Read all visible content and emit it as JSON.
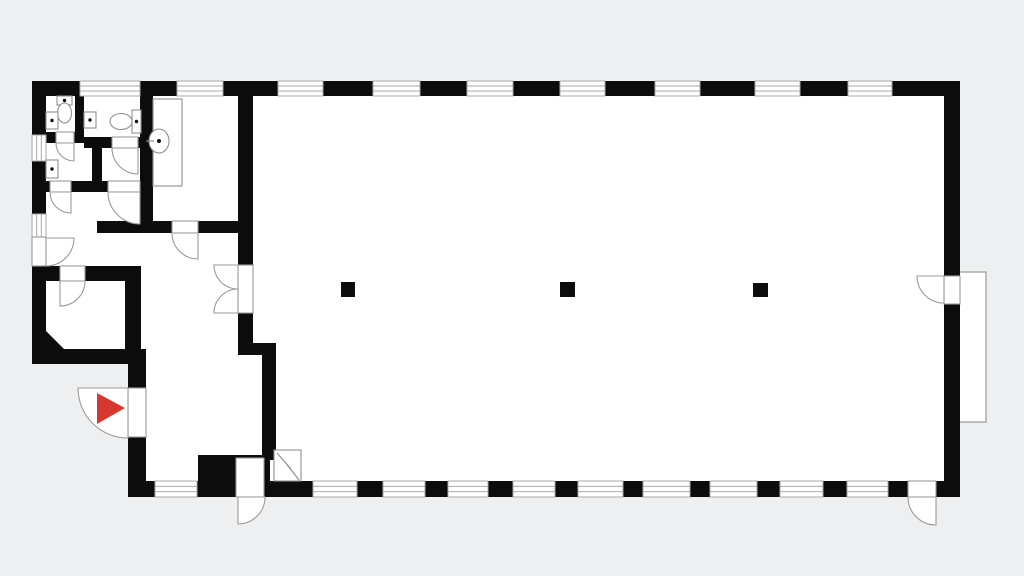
{
  "meta": {
    "title": "floor-plan-drawing"
  },
  "colors": {
    "background": "#eeeff0",
    "floor": "#ffffff",
    "wall": "#0c0c0c",
    "line": "#9a9a9a",
    "window_line": "#a9a9a9",
    "fixture_line": "#8f8f8f",
    "dot": "#111111",
    "marker_red": "#d63731"
  },
  "plan": {
    "viewbox": "0 0 1024 576",
    "floor_outline": "32,81 960,81 960,497 128,497 128,364 32,364",
    "platform": {
      "name": "exterior-platform",
      "x": 956,
      "y": 272,
      "w": 30,
      "h": 150
    },
    "walls": [
      [
        32,
        81,
        48,
        15
      ],
      [
        140,
        81,
        37,
        15
      ],
      [
        223,
        81,
        55,
        15
      ],
      [
        323,
        81,
        50,
        15
      ],
      [
        420,
        81,
        47,
        15
      ],
      [
        513,
        81,
        47,
        15
      ],
      [
        605,
        81,
        50,
        15
      ],
      [
        700,
        81,
        55,
        15
      ],
      [
        800,
        81,
        48,
        15
      ],
      [
        892,
        81,
        68,
        15
      ],
      [
        128,
        481,
        27,
        16
      ],
      [
        197,
        481,
        39,
        16
      ],
      [
        264,
        481,
        49,
        16
      ],
      [
        357,
        481,
        26,
        16
      ],
      [
        425,
        481,
        23,
        16
      ],
      [
        488,
        481,
        25,
        16
      ],
      [
        555,
        481,
        23,
        16
      ],
      [
        623,
        481,
        20,
        16
      ],
      [
        690,
        481,
        20,
        16
      ],
      [
        757,
        481,
        23,
        16
      ],
      [
        823,
        481,
        24,
        16
      ],
      [
        888,
        481,
        20,
        16
      ],
      [
        936,
        481,
        24,
        16
      ],
      [
        32,
        81,
        14,
        54
      ],
      [
        32,
        161,
        14,
        53
      ],
      [
        32,
        266,
        14,
        98
      ],
      [
        944,
        81,
        16,
        195
      ],
      [
        944,
        304,
        16,
        193
      ],
      [
        75,
        96,
        9,
        36
      ],
      [
        46,
        132,
        10,
        11
      ],
      [
        74,
        132,
        10,
        11
      ],
      [
        84,
        137,
        28,
        11
      ],
      [
        138,
        137,
        15,
        11
      ],
      [
        92,
        143,
        10,
        39
      ],
      [
        46,
        181,
        4,
        11
      ],
      [
        71,
        181,
        37,
        11
      ],
      [
        140,
        181,
        13,
        11
      ],
      [
        140,
        96,
        13,
        125
      ],
      [
        97,
        221,
        75,
        12
      ],
      [
        198,
        221,
        40,
        12
      ],
      [
        238,
        96,
        15,
        169
      ],
      [
        238,
        313,
        15,
        30
      ],
      [
        238,
        343,
        38,
        12
      ],
      [
        262,
        355,
        14,
        105
      ],
      [
        46,
        266,
        14,
        15
      ],
      [
        85,
        266,
        56,
        15
      ],
      [
        125,
        266,
        16,
        98
      ],
      [
        32,
        349,
        114,
        15
      ],
      [
        128,
        364,
        18,
        24
      ],
      [
        128,
        437,
        18,
        44
      ],
      [
        198,
        455,
        72,
        26
      ]
    ],
    "chamfers": [
      "46,331 46,349 64,349"
    ],
    "windows": [
      {
        "x": 80,
        "y": 81,
        "w": 60,
        "h": 15,
        "dir": "h"
      },
      {
        "x": 177,
        "y": 81,
        "w": 46,
        "h": 15,
        "dir": "h"
      },
      {
        "x": 278,
        "y": 81,
        "w": 45,
        "h": 15,
        "dir": "h"
      },
      {
        "x": 373,
        "y": 81,
        "w": 47,
        "h": 15,
        "dir": "h"
      },
      {
        "x": 467,
        "y": 81,
        "w": 46,
        "h": 15,
        "dir": "h"
      },
      {
        "x": 560,
        "y": 81,
        "w": 45,
        "h": 15,
        "dir": "h"
      },
      {
        "x": 655,
        "y": 81,
        "w": 45,
        "h": 15,
        "dir": "h"
      },
      {
        "x": 755,
        "y": 81,
        "w": 45,
        "h": 15,
        "dir": "h"
      },
      {
        "x": 848,
        "y": 81,
        "w": 44,
        "h": 15,
        "dir": "h"
      },
      {
        "x": 155,
        "y": 481,
        "w": 42,
        "h": 16,
        "dir": "h"
      },
      {
        "x": 313,
        "y": 481,
        "w": 44,
        "h": 16,
        "dir": "h"
      },
      {
        "x": 383,
        "y": 481,
        "w": 42,
        "h": 16,
        "dir": "h"
      },
      {
        "x": 448,
        "y": 481,
        "w": 40,
        "h": 16,
        "dir": "h"
      },
      {
        "x": 513,
        "y": 481,
        "w": 42,
        "h": 16,
        "dir": "h"
      },
      {
        "x": 578,
        "y": 481,
        "w": 45,
        "h": 16,
        "dir": "h"
      },
      {
        "x": 643,
        "y": 481,
        "w": 47,
        "h": 16,
        "dir": "h"
      },
      {
        "x": 710,
        "y": 481,
        "w": 47,
        "h": 16,
        "dir": "h"
      },
      {
        "x": 780,
        "y": 481,
        "w": 43,
        "h": 16,
        "dir": "h"
      },
      {
        "x": 847,
        "y": 481,
        "w": 41,
        "h": 16,
        "dir": "h"
      },
      {
        "x": 32,
        "y": 135,
        "w": 14,
        "h": 26,
        "dir": "v"
      },
      {
        "x": 32,
        "y": 214,
        "w": 14,
        "h": 23,
        "dir": "v"
      }
    ],
    "doors": [
      {
        "name": "main-entrance-door",
        "leaf": [
          128,
          388,
          18,
          49
        ],
        "arc": "M78,388 A50,50 0 0 0 128,438 L128,388 Z"
      },
      {
        "name": "south-left-exit-door",
        "leaf": [
          236,
          458,
          28,
          39
        ],
        "arc": "M265,497 A27,27 0 0 1 238,524 L238,497 Z"
      },
      {
        "name": "south-right-exit-door",
        "leaf": [
          908,
          481,
          28,
          16
        ],
        "arc": "M908,497 A28,28 0 0 0 936,525 L936,497 Z"
      },
      {
        "name": "east-exit-door",
        "leaf": [
          944,
          276,
          16,
          28
        ],
        "arc": "M917,276 A27,27 0 0 0 944,303 L944,276 Z"
      },
      {
        "name": "hall-double-door-upper",
        "leaf": [
          238,
          265,
          15,
          48
        ],
        "arc": "M214,265 A24,24 0 0 0 238,289 L238,265 Z"
      },
      {
        "name": "hall-double-door-lower",
        "leaf": null,
        "arc": "M214,313 A24,24 0 0 1 238,289 L238,313 Z"
      },
      {
        "name": "west-side-door",
        "leaf": [
          32,
          237,
          14,
          29
        ],
        "arc": "M74,238 A28,28 0 0 1 46,266 L46,238 Z"
      },
      {
        "name": "storage-room-door",
        "leaf": [
          60,
          266,
          25,
          15
        ],
        "arc": "M85,281 A25,25 0 0 1 60,306 L60,281 Z"
      },
      {
        "name": "kitchenette-door",
        "leaf": [
          172,
          221,
          26,
          12
        ],
        "arc": "M172,233 A26,26 0 0 0 198,259 L198,233 Z"
      },
      {
        "name": "wc1-door",
        "leaf": [
          56,
          132,
          18,
          11
        ],
        "arc": "M56,143 A18,18 0 0 0 74,161 L74,143 Z"
      },
      {
        "name": "wc2-door",
        "leaf": [
          112,
          137,
          26,
          11
        ],
        "arc": "M112,148 A26,26 0 0 0 138,174 L138,148 Z"
      },
      {
        "name": "washroom-1-door",
        "leaf": [
          50,
          181,
          21,
          11
        ],
        "arc": "M50,192 A21,21 0 0 0 71,213 L71,192 Z"
      },
      {
        "name": "washroom-2-door",
        "leaf": [
          108,
          181,
          32,
          11
        ],
        "arc": "M108,192 A32,32 0 0 0 140,224 L140,192 Z"
      }
    ],
    "fixtures": [
      {
        "name": "wc1-cistern",
        "t": "rect",
        "v": [
          57,
          96,
          15,
          9
        ]
      },
      {
        "name": "wc1-cistern-button",
        "t": "dot",
        "v": [
          64.5,
          100.5,
          1.7
        ]
      },
      {
        "name": "wc1-bowl",
        "t": "ellipse",
        "v": [
          64.5,
          113,
          7,
          10
        ]
      },
      {
        "name": "sink-1",
        "t": "rect",
        "v": [
          46,
          112,
          12,
          17
        ]
      },
      {
        "name": "sink-1-drain",
        "t": "dot",
        "v": [
          52,
          120.5,
          1.7
        ]
      },
      {
        "name": "sink-2",
        "t": "rect",
        "v": [
          84,
          112,
          12,
          16
        ]
      },
      {
        "name": "sink-2-drain",
        "t": "dot",
        "v": [
          90,
          120,
          1.7
        ]
      },
      {
        "name": "wc2-cistern",
        "t": "rect",
        "v": [
          132,
          110,
          9,
          23
        ]
      },
      {
        "name": "wc2-cistern-button",
        "t": "dot",
        "v": [
          136.5,
          121.5,
          1.7
        ]
      },
      {
        "name": "wc2-bowl",
        "t": "ellipse",
        "v": [
          121,
          121.5,
          11,
          8
        ]
      },
      {
        "name": "sink-3",
        "t": "rect",
        "v": [
          46,
          160,
          12,
          18
        ]
      },
      {
        "name": "sink-3-drain",
        "t": "dot",
        "v": [
          52,
          169,
          1.7
        ]
      },
      {
        "name": "kitchen-counter",
        "t": "rect",
        "v": [
          153,
          99,
          29,
          87
        ]
      },
      {
        "name": "round-basin",
        "t": "ellipse",
        "v": [
          159,
          141,
          10,
          12
        ]
      },
      {
        "name": "round-basin-drain",
        "t": "dot",
        "v": [
          159,
          141,
          2
        ]
      },
      {
        "name": "basin-tap-line",
        "t": "line",
        "v": [
          146,
          141,
          154,
          141
        ]
      },
      {
        "name": "heater-box",
        "t": "rect",
        "v": [
          274,
          450,
          27,
          31
        ]
      },
      {
        "name": "heater-symbol",
        "t": "polyline",
        "v": "277,453 291,469 285,462 299,480"
      }
    ],
    "columns": [
      [
        341,
        282,
        14,
        15
      ],
      [
        560,
        282,
        15,
        15
      ],
      [
        753,
        283,
        15,
        14
      ]
    ],
    "entrance_marker": {
      "name": "entrance-arrow-icon",
      "points": "97,393 97,424 125,408",
      "color": "#d63731"
    }
  }
}
